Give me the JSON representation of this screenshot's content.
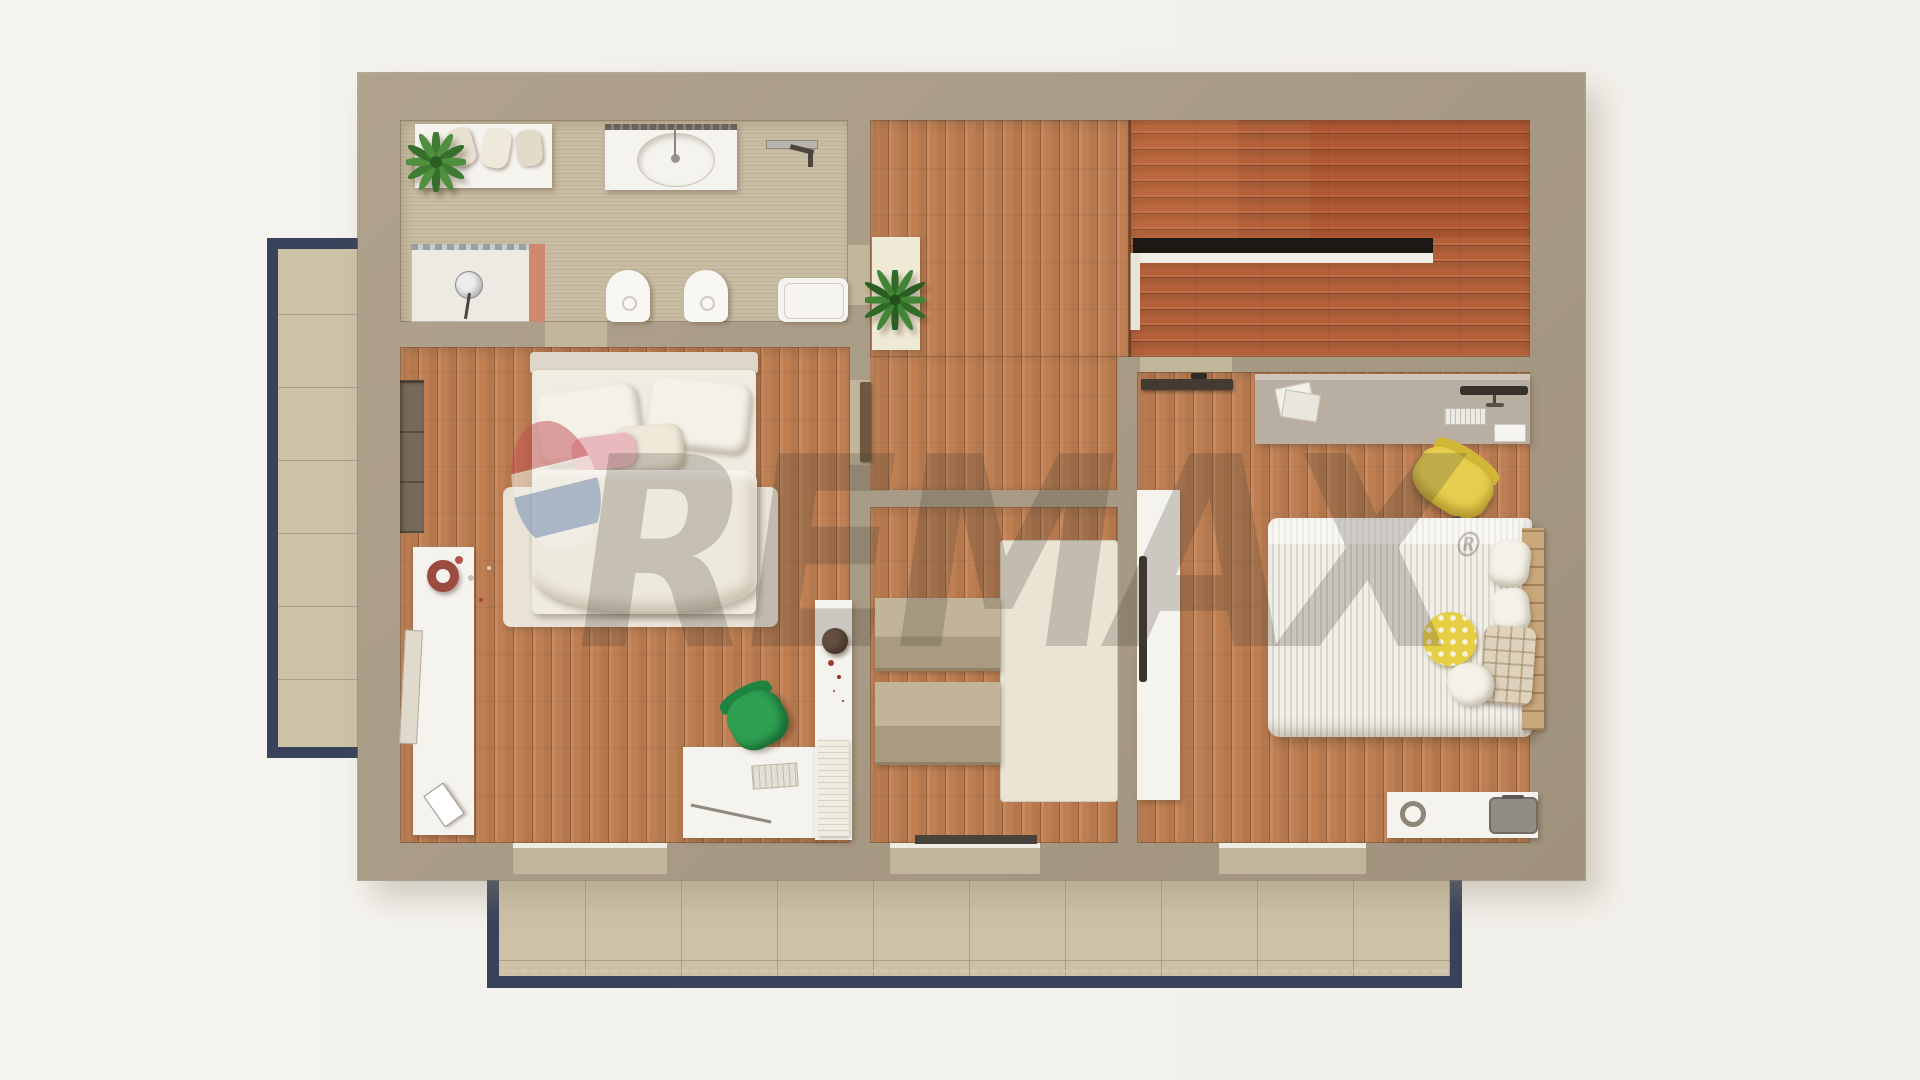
{
  "image_type": "3d-rendered top-down floor plan (upper storey)",
  "watermark": {
    "brand": "REMAX",
    "registered": "®"
  },
  "palette": {
    "background": "#f3f1ec",
    "wall": "#a99c86",
    "oak_floor": "#bf7f53",
    "stair_floor": "#b4613a",
    "bathroom_floor": "#c8bda3",
    "balcony_tile": "#cdc2a8",
    "balcony_border": "#38425a",
    "watermark_red": "#c14e52",
    "watermark_blue": "#748cb2",
    "chair_green": "#2fa052",
    "chair_yellow": "#e6cf4f"
  },
  "rooms": [
    {
      "id": "bathroom",
      "position": "top-left"
    },
    {
      "id": "landing-hallway",
      "position": "top-center"
    },
    {
      "id": "staircase",
      "position": "top-right"
    },
    {
      "id": "bedroom-left",
      "position": "left"
    },
    {
      "id": "closet-room",
      "position": "bottom-center"
    },
    {
      "id": "bedroom-right",
      "position": "right"
    },
    {
      "id": "balcony-left",
      "position": "outside-left"
    },
    {
      "id": "balcony-bottom",
      "position": "outside-bottom"
    }
  ],
  "furniture": {
    "bathroom": [
      "counter-with-towels",
      "potted-plant",
      "sink-vanity",
      "towel-rail",
      "shower",
      "toilet",
      "bidet",
      "bathtub"
    ],
    "landing-hallway": [
      "potted-plant-on-mat",
      "stair-void"
    ],
    "bedroom-left": [
      "double-bed",
      "pillows",
      "rug",
      "wall-niche",
      "sideboard-with-wreath",
      "leaning-picture",
      "desk",
      "keyboard",
      "green-office-chair",
      "bookshelf-with-plant",
      "book-stack"
    ],
    "closet-room": [
      "dresser-upper",
      "dresser-lower",
      "cream-rug",
      "doormat"
    ],
    "bedroom-right": [
      "desk",
      "papers",
      "monitor",
      "keyboard",
      "yellow-office-chair",
      "striped-double-bed",
      "plaid-pillow",
      "yellow-polka-pillow",
      "wood-headboard",
      "white-wardrobe",
      "low-shelf",
      "gray-tray"
    ],
    "balconies": [
      "tiled-floor",
      "dark-railing-border"
    ]
  }
}
